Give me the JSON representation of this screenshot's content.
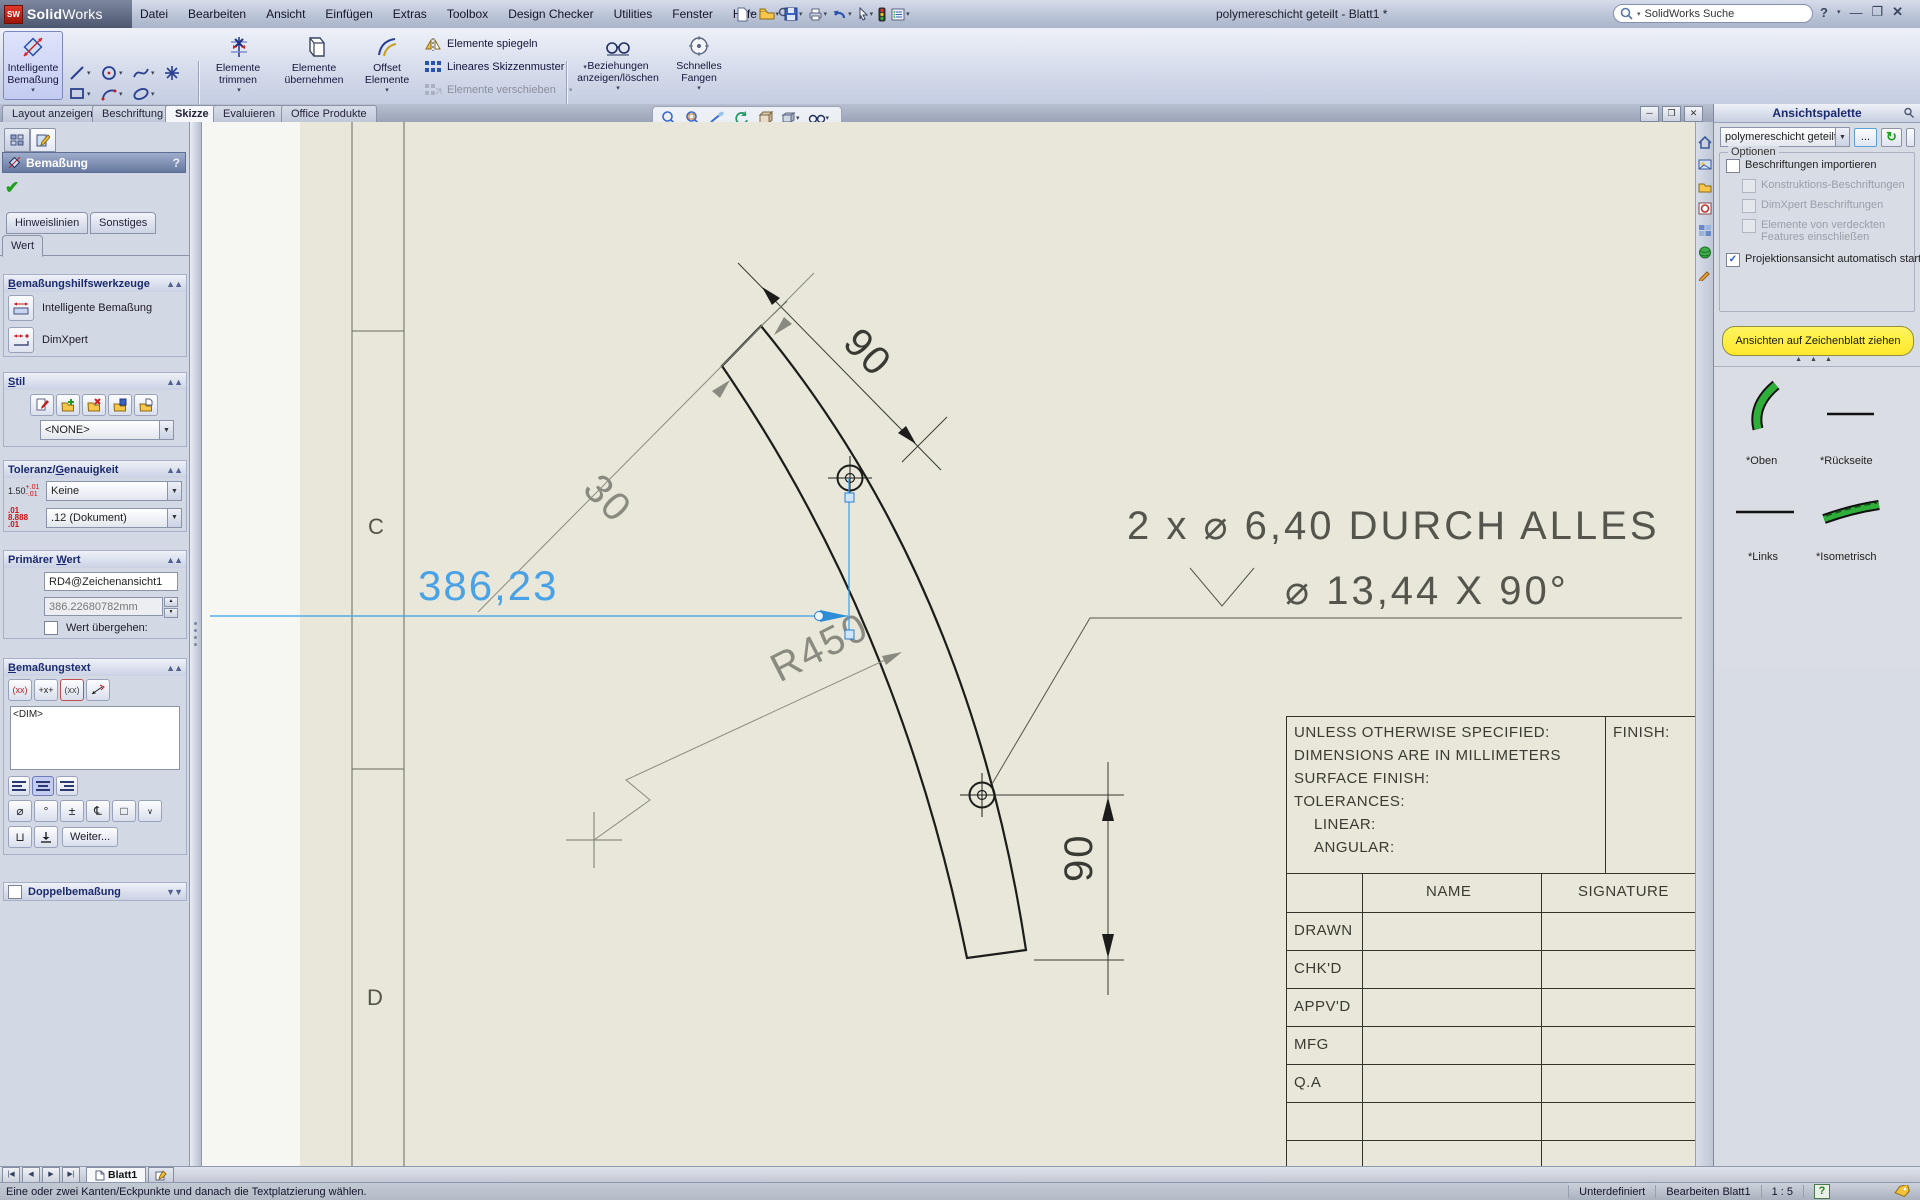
{
  "window": {
    "logo_bold": "Solid",
    "logo_light": "Works",
    "title": "polymereschicht geteilt - Blatt1 *",
    "search_placeholder": "SolidWorks Suche"
  },
  "menu": {
    "items": [
      "Datei",
      "Bearbeiten",
      "Ansicht",
      "Einfügen",
      "Extras",
      "Toolbox",
      "Design Checker",
      "Utilities",
      "Fenster",
      "Hilfe"
    ]
  },
  "toolbar": {
    "smart_dim_line1": "Intelligente",
    "smart_dim_line2": "Bemaßung",
    "trim": "Elemente trimmen",
    "convert": "Elemente übernehmen",
    "offset_line1": "Offset",
    "offset_line2": "Elemente",
    "mirror": "Elemente spiegeln",
    "linear_pattern": "Lineares Skizzenmuster",
    "move": "Elemente verschieben",
    "relations_line1": "Beziehungen",
    "relations_line2": "anzeigen/löschen",
    "snap_line1": "Schnelles",
    "snap_line2": "Fangen"
  },
  "tabs": {
    "items": [
      "Layout anzeigen",
      "Beschriftung",
      "Skizze",
      "Evaluieren",
      "Office Produkte"
    ],
    "active": "Skizze"
  },
  "pm": {
    "title": "Bemaßung",
    "help": "?",
    "tab_leaders": "Hinweislinien",
    "tab_other": "Sonstiges",
    "tab_value": "Wert",
    "sec_tools": "Bemaßungshilfswerkzeuge",
    "tool_smart": "Intelligente Bemaßung",
    "tool_dimxpert": "DimXpert",
    "sec_style": "Stil",
    "style_value": "<NONE>",
    "sec_tol": "Toleranz/Genauigkeit",
    "tol_value": "Keine",
    "prec_value": ".12 (Dokument)",
    "tol_icon_main": "1.50",
    "tol_icon_sup": "+.01",
    "tol_icon_sub": "-.01",
    "prec_icon_main": "8.888",
    "prec_icon_sup": ".01",
    "prec_icon_sub": ".01",
    "sec_primary": "Primärer Wert",
    "primary_name": "RD4@Zeichenansicht1",
    "primary_value": "386.22680782mm",
    "override_label": "Wert übergehen:",
    "sec_dimtext": "Bemaßungstext",
    "dim_token": "<DIM>",
    "btn_paren": "(xx)",
    "btn_offsettext": "+x+",
    "btn_oval": "(xx)",
    "symbols": [
      "⌀",
      "°",
      "±",
      "℄",
      "□"
    ],
    "more_button": "Weiter...",
    "sec_dual": "Doppelbemaßung"
  },
  "canvas": {
    "zones": [
      "C",
      "D"
    ],
    "dim_width": "90",
    "dim_thickness": "30",
    "dim_radius": "R450",
    "dim_selected": "386,23",
    "dim_height": "90",
    "callout_line1": "2 x ⌀ 6,40 DURCH ALLES",
    "callout_line2": "⌀ 13,44 X 90°",
    "titleblock": {
      "notes": [
        "UNLESS OTHERWISE SPECIFIED:",
        "DIMENSIONS ARE IN MILLIMETERS",
        "SURFACE FINISH:",
        "TOLERANCES:",
        "LINEAR:",
        "ANGULAR:"
      ],
      "finish": "FINISH:",
      "col_name": "NAME",
      "col_signature": "SIGNATURE",
      "rows": [
        "DRAWN",
        "CHK'D",
        "APPV'D",
        "MFG",
        "Q.A"
      ]
    }
  },
  "palette": {
    "title": "Ansichtspalette",
    "doc_dropdown": "polymereschicht geteilt",
    "browse_button": "...",
    "options_label": "Optionen",
    "checks": [
      "Beschriftungen importieren",
      "Konstruktions-Beschriftungen",
      "DimXpert Beschriftungen",
      "Elemente von verdeckten Features einschließen",
      "Projektionsansicht automatisch starten"
    ],
    "drag_button": "Ansichten auf Zeichenblatt ziehen",
    "views": [
      "*Oben",
      "*Rückseite",
      "*Links",
      "*Isometrisch"
    ]
  },
  "sheetbar": {
    "tab": "Blatt1"
  },
  "status": {
    "hint": "Eine oder zwei Kanten/Eckpunkte und danach die Textplatzierung wählen.",
    "state": "Unterdefiniert",
    "mode": "Bearbeiten Blatt1",
    "scale": "1 : 5"
  },
  "colors": {
    "accent_blue": "#4aa2e6",
    "sheet": "#e8e7d9",
    "highlight_yellow": "#ffe942",
    "selection_blue": "#2d7dd2"
  }
}
